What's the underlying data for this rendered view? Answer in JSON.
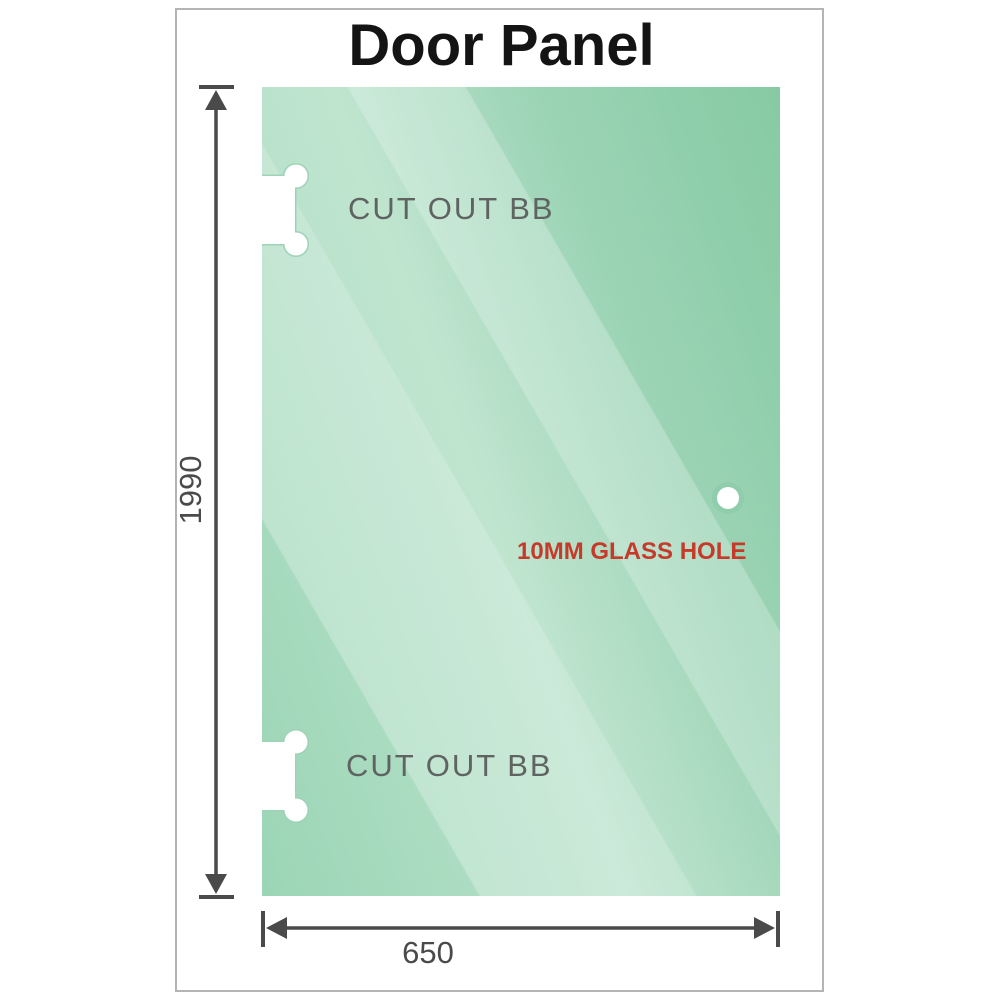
{
  "title": "Door Panel",
  "glass_panel": {
    "cutout_top_label": "CUT OUT BB",
    "cutout_bottom_label": "CUT OUT BB",
    "hole_label": "10MM GLASS HOLE"
  },
  "dimensions": {
    "height_value": "1990",
    "width_value": "650"
  },
  "colors": {
    "glass-dark": "#7cc69b",
    "glass-mid": "#9bd5b6",
    "glass-light": "#b9e2ca",
    "hole-ring": "#8fcdad",
    "cutout-edge": "#9ed3b8",
    "dim-line": "#4a4a4a",
    "dim-text": "#4a4a4a",
    "cutout-label": "#5f6462",
    "hole-label": "#c63a2b",
    "title-text": "#141414",
    "frame-border": "#b4b4b4"
  }
}
